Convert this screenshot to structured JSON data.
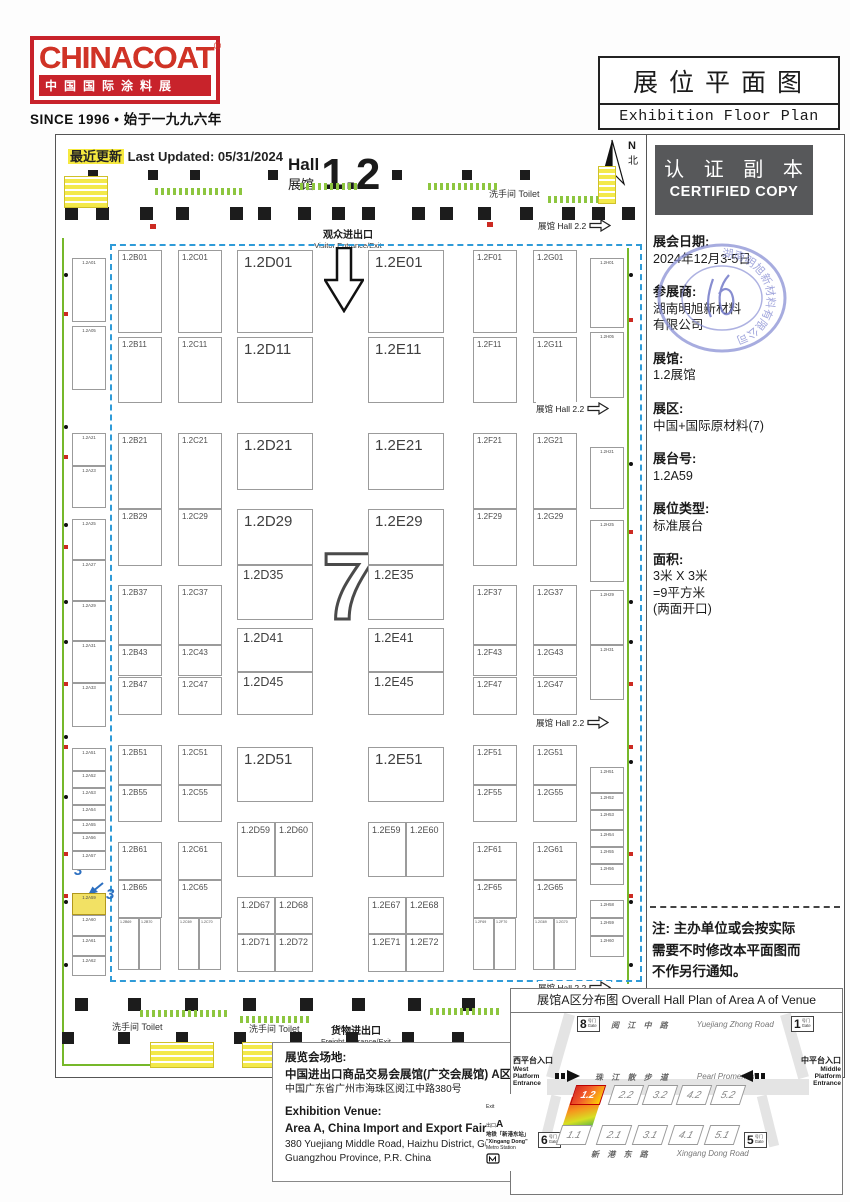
{
  "logo": {
    "brand": "CHINACOAT",
    "reg": "®",
    "subtitle": "中国国际涂料展",
    "since": "SINCE 1996 • 始于一九九六年"
  },
  "title_box": {
    "zh": "展位平面图",
    "en": "Exhibition Floor Plan"
  },
  "certified": {
    "zh": "认 证 副 本",
    "en": "CERTIFIED COPY"
  },
  "sidebar": {
    "stamp_text": "湖南明旭新材料有限公司",
    "details": [
      {
        "label": "展会日期:",
        "lines": [
          "2024年12月3-5日"
        ]
      },
      {
        "label": "参展商:",
        "lines": [
          "湖南明旭新材料",
          "有限公司"
        ]
      },
      {
        "label": "展馆:",
        "lines": [
          "1.2展馆"
        ]
      },
      {
        "label": "展区:",
        "lines": [
          "中国+国际原材料(7)"
        ]
      },
      {
        "label": "展台号:",
        "lines": [
          "1.2A59"
        ]
      },
      {
        "label": "展位类型:",
        "lines": [
          "标准展台"
        ]
      },
      {
        "label": "面积:",
        "lines": [
          "3米 X 3米",
          "=9平方米",
          "(两面开口)"
        ]
      }
    ],
    "note_lines": [
      "注: 主办单位或会按实际",
      "需要不时修改本平面图而",
      "不作另行通知。"
    ]
  },
  "floorplan": {
    "last_updated_zh": "最近更新",
    "last_updated_en": " Last Updated: 05/31/2024",
    "hall_en": "Hall",
    "hall_zh": "展馆",
    "hall_number": "1.2",
    "compass_n": "N",
    "compass_bei": "北",
    "visitor_zh": "观众进出口",
    "visitor_en": "Visitor Entrance/Exit",
    "freight_zh": "货物进出口",
    "freight_en": "Freight Entrance/Exit",
    "toilet_label": "洗手间 Toilet",
    "toilet_markers": [
      {
        "x": 489,
        "y": 187
      },
      {
        "x": 112,
        "y": 1020
      },
      {
        "x": 249,
        "y": 1022
      }
    ],
    "hall22_label": "展馆 Hall 2.2",
    "hall22_markers": [
      {
        "x": 538,
        "y": 219
      },
      {
        "x": 536,
        "y": 402
      },
      {
        "x": 536,
        "y": 716
      },
      {
        "x": 538,
        "y": 981
      }
    ],
    "zone_number": "7",
    "dim_marks": [
      "3",
      "3"
    ],
    "booths": [
      {
        "id": "1.2A01",
        "x": 72,
        "y": 258,
        "w": 34,
        "h": 64,
        "c": "xs"
      },
      {
        "id": "1.2A05",
        "x": 72,
        "y": 326,
        "w": 34,
        "h": 64,
        "c": "xs"
      },
      {
        "id": "1.2A21",
        "x": 72,
        "y": 433,
        "w": 34,
        "h": 33,
        "c": "xs"
      },
      {
        "id": "1.2A23",
        "x": 72,
        "y": 466,
        "w": 34,
        "h": 42,
        "c": "xs"
      },
      {
        "id": "1.2A25",
        "x": 72,
        "y": 519,
        "w": 34,
        "h": 41,
        "c": "xs"
      },
      {
        "id": "1.2A27",
        "x": 72,
        "y": 560,
        "w": 34,
        "h": 41,
        "c": "xs"
      },
      {
        "id": "1.2A29",
        "x": 72,
        "y": 601,
        "w": 34,
        "h": 40,
        "c": "xs"
      },
      {
        "id": "1.2A31",
        "x": 72,
        "y": 641,
        "w": 34,
        "h": 42,
        "c": "xs"
      },
      {
        "id": "1.2A33",
        "x": 72,
        "y": 683,
        "w": 34,
        "h": 44,
        "c": "xs"
      },
      {
        "id": "1.2A51",
        "x": 72,
        "y": 748,
        "w": 34,
        "h": 23,
        "c": "xs"
      },
      {
        "id": "1.2A52",
        "x": 72,
        "y": 771,
        "w": 34,
        "h": 17,
        "c": "xs"
      },
      {
        "id": "1.2A53",
        "x": 72,
        "y": 788,
        "w": 34,
        "h": 17,
        "c": "xs"
      },
      {
        "id": "1.2A54",
        "x": 72,
        "y": 805,
        "w": 34,
        "h": 15,
        "c": "xs"
      },
      {
        "id": "1.2A55",
        "x": 72,
        "y": 820,
        "w": 34,
        "h": 13,
        "c": "xs"
      },
      {
        "id": "1.2A56",
        "x": 72,
        "y": 833,
        "w": 34,
        "h": 18,
        "c": "xs"
      },
      {
        "id": "1.2A57",
        "x": 72,
        "y": 851,
        "w": 34,
        "h": 19,
        "c": "xs"
      },
      {
        "id": "1.2A59",
        "x": 72,
        "y": 893,
        "w": 34,
        "h": 22,
        "c": "xs",
        "hl": true
      },
      {
        "id": "1.2A60",
        "x": 72,
        "y": 915,
        "w": 34,
        "h": 21,
        "c": "xs"
      },
      {
        "id": "1.2A61",
        "x": 72,
        "y": 936,
        "w": 34,
        "h": 20,
        "c": "xs"
      },
      {
        "id": "1.2A62",
        "x": 72,
        "y": 956,
        "w": 34,
        "h": 20,
        "c": "xs"
      },
      {
        "id": "1.2B01",
        "x": 118,
        "y": 250,
        "w": 44,
        "h": 83
      },
      {
        "id": "1.2B11",
        "x": 118,
        "y": 337,
        "w": 44,
        "h": 66
      },
      {
        "id": "1.2B21",
        "x": 118,
        "y": 433,
        "w": 44,
        "h": 76
      },
      {
        "id": "1.2B29",
        "x": 118,
        "y": 509,
        "w": 44,
        "h": 57
      },
      {
        "id": "1.2B37",
        "x": 118,
        "y": 585,
        "w": 44,
        "h": 60
      },
      {
        "id": "1.2B43",
        "x": 118,
        "y": 645,
        "w": 44,
        "h": 31
      },
      {
        "id": "1.2B47",
        "x": 118,
        "y": 677,
        "w": 44,
        "h": 38
      },
      {
        "id": "1.2B51",
        "x": 118,
        "y": 745,
        "w": 44,
        "h": 40
      },
      {
        "id": "1.2B55",
        "x": 118,
        "y": 785,
        "w": 44,
        "h": 37
      },
      {
        "id": "1.2B61",
        "x": 118,
        "y": 842,
        "w": 44,
        "h": 38
      },
      {
        "id": "1.2B65",
        "x": 118,
        "y": 880,
        "w": 44,
        "h": 38
      },
      {
        "id": "1.2B69",
        "x": 118,
        "y": 918,
        "w": 21,
        "h": 52,
        "c": "xxs"
      },
      {
        "id": "1.2B70",
        "x": 139,
        "y": 918,
        "w": 22,
        "h": 52,
        "c": "xxs"
      },
      {
        "id": "1.2C01",
        "x": 178,
        "y": 250,
        "w": 44,
        "h": 83
      },
      {
        "id": "1.2C11",
        "x": 178,
        "y": 337,
        "w": 44,
        "h": 66
      },
      {
        "id": "1.2C21",
        "x": 178,
        "y": 433,
        "w": 44,
        "h": 76
      },
      {
        "id": "1.2C29",
        "x": 178,
        "y": 509,
        "w": 44,
        "h": 57
      },
      {
        "id": "1.2C37",
        "x": 178,
        "y": 585,
        "w": 44,
        "h": 60
      },
      {
        "id": "1.2C43",
        "x": 178,
        "y": 645,
        "w": 44,
        "h": 31
      },
      {
        "id": "1.2C47",
        "x": 178,
        "y": 677,
        "w": 44,
        "h": 38
      },
      {
        "id": "1.2C51",
        "x": 178,
        "y": 745,
        "w": 44,
        "h": 40
      },
      {
        "id": "1.2C55",
        "x": 178,
        "y": 785,
        "w": 44,
        "h": 37
      },
      {
        "id": "1.2C61",
        "x": 178,
        "y": 842,
        "w": 44,
        "h": 38
      },
      {
        "id": "1.2C65",
        "x": 178,
        "y": 880,
        "w": 44,
        "h": 38
      },
      {
        "id": "1.2C69",
        "x": 178,
        "y": 918,
        "w": 21,
        "h": 52,
        "c": "xxs"
      },
      {
        "id": "1.2C70",
        "x": 199,
        "y": 918,
        "w": 22,
        "h": 52,
        "c": "xxs"
      },
      {
        "id": "1.2D01",
        "x": 237,
        "y": 250,
        "w": 76,
        "h": 83,
        "c": "l"
      },
      {
        "id": "1.2D11",
        "x": 237,
        "y": 337,
        "w": 76,
        "h": 66,
        "c": "l"
      },
      {
        "id": "1.2D21",
        "x": 237,
        "y": 433,
        "w": 76,
        "h": 57,
        "c": "l"
      },
      {
        "id": "1.2D29",
        "x": 237,
        "y": 509,
        "w": 76,
        "h": 56,
        "c": "l"
      },
      {
        "id": "1.2D35",
        "x": 237,
        "y": 565,
        "w": 76,
        "h": 55,
        "c": "l2"
      },
      {
        "id": "1.2D41",
        "x": 237,
        "y": 628,
        "w": 76,
        "h": 44,
        "c": "l2"
      },
      {
        "id": "1.2D45",
        "x": 237,
        "y": 672,
        "w": 76,
        "h": 43,
        "c": "l2"
      },
      {
        "id": "1.2D51",
        "x": 237,
        "y": 747,
        "w": 76,
        "h": 55,
        "c": "l"
      },
      {
        "id": "1.2D59",
        "x": 237,
        "y": 822,
        "w": 38,
        "h": 55,
        "c": "m"
      },
      {
        "id": "1.2D60",
        "x": 275,
        "y": 822,
        "w": 38,
        "h": 55,
        "c": "m"
      },
      {
        "id": "1.2D67",
        "x": 237,
        "y": 897,
        "w": 38,
        "h": 37,
        "c": "m"
      },
      {
        "id": "1.2D68",
        "x": 275,
        "y": 897,
        "w": 38,
        "h": 37,
        "c": "m"
      },
      {
        "id": "1.2D71",
        "x": 237,
        "y": 934,
        "w": 38,
        "h": 38,
        "c": "m"
      },
      {
        "id": "1.2D72",
        "x": 275,
        "y": 934,
        "w": 38,
        "h": 38,
        "c": "m"
      },
      {
        "id": "1.2E01",
        "x": 368,
        "y": 250,
        "w": 76,
        "h": 83,
        "c": "l"
      },
      {
        "id": "1.2E11",
        "x": 368,
        "y": 337,
        "w": 76,
        "h": 66,
        "c": "l"
      },
      {
        "id": "1.2E21",
        "x": 368,
        "y": 433,
        "w": 76,
        "h": 57,
        "c": "l"
      },
      {
        "id": "1.2E29",
        "x": 368,
        "y": 509,
        "w": 76,
        "h": 56,
        "c": "l"
      },
      {
        "id": "1.2E35",
        "x": 368,
        "y": 565,
        "w": 76,
        "h": 55,
        "c": "l2"
      },
      {
        "id": "1.2E41",
        "x": 368,
        "y": 628,
        "w": 76,
        "h": 44,
        "c": "l2"
      },
      {
        "id": "1.2E45",
        "x": 368,
        "y": 672,
        "w": 76,
        "h": 43,
        "c": "l2"
      },
      {
        "id": "1.2E51",
        "x": 368,
        "y": 747,
        "w": 76,
        "h": 55,
        "c": "l"
      },
      {
        "id": "1.2E59",
        "x": 368,
        "y": 822,
        "w": 38,
        "h": 55,
        "c": "m"
      },
      {
        "id": "1.2E60",
        "x": 406,
        "y": 822,
        "w": 38,
        "h": 55,
        "c": "m"
      },
      {
        "id": "1.2E67",
        "x": 368,
        "y": 897,
        "w": 38,
        "h": 37,
        "c": "m"
      },
      {
        "id": "1.2E68",
        "x": 406,
        "y": 897,
        "w": 38,
        "h": 37,
        "c": "m"
      },
      {
        "id": "1.2E71",
        "x": 368,
        "y": 934,
        "w": 38,
        "h": 38,
        "c": "m"
      },
      {
        "id": "1.2E72",
        "x": 406,
        "y": 934,
        "w": 38,
        "h": 38,
        "c": "m"
      },
      {
        "id": "1.2F01",
        "x": 473,
        "y": 250,
        "w": 44,
        "h": 83
      },
      {
        "id": "1.2F11",
        "x": 473,
        "y": 337,
        "w": 44,
        "h": 66
      },
      {
        "id": "1.2F21",
        "x": 473,
        "y": 433,
        "w": 44,
        "h": 76
      },
      {
        "id": "1.2F29",
        "x": 473,
        "y": 509,
        "w": 44,
        "h": 57
      },
      {
        "id": "1.2F37",
        "x": 473,
        "y": 585,
        "w": 44,
        "h": 60
      },
      {
        "id": "1.2F43",
        "x": 473,
        "y": 645,
        "w": 44,
        "h": 31
      },
      {
        "id": "1.2F47",
        "x": 473,
        "y": 677,
        "w": 44,
        "h": 38
      },
      {
        "id": "1.2F51",
        "x": 473,
        "y": 745,
        "w": 44,
        "h": 40
      },
      {
        "id": "1.2F55",
        "x": 473,
        "y": 785,
        "w": 44,
        "h": 37
      },
      {
        "id": "1.2F61",
        "x": 473,
        "y": 842,
        "w": 44,
        "h": 38
      },
      {
        "id": "1.2F65",
        "x": 473,
        "y": 880,
        "w": 44,
        "h": 38
      },
      {
        "id": "1.2F69",
        "x": 473,
        "y": 918,
        "w": 21,
        "h": 52,
        "c": "xxs"
      },
      {
        "id": "1.2F70",
        "x": 494,
        "y": 918,
        "w": 22,
        "h": 52,
        "c": "xxs"
      },
      {
        "id": "1.2G01",
        "x": 533,
        "y": 250,
        "w": 44,
        "h": 83
      },
      {
        "id": "1.2G11",
        "x": 533,
        "y": 337,
        "w": 44,
        "h": 66
      },
      {
        "id": "1.2G21",
        "x": 533,
        "y": 433,
        "w": 44,
        "h": 76
      },
      {
        "id": "1.2G29",
        "x": 533,
        "y": 509,
        "w": 44,
        "h": 57
      },
      {
        "id": "1.2G37",
        "x": 533,
        "y": 585,
        "w": 44,
        "h": 60
      },
      {
        "id": "1.2G43",
        "x": 533,
        "y": 645,
        "w": 44,
        "h": 31
      },
      {
        "id": "1.2G47",
        "x": 533,
        "y": 677,
        "w": 44,
        "h": 38
      },
      {
        "id": "1.2G51",
        "x": 533,
        "y": 745,
        "w": 44,
        "h": 40
      },
      {
        "id": "1.2G55",
        "x": 533,
        "y": 785,
        "w": 44,
        "h": 37
      },
      {
        "id": "1.2G61",
        "x": 533,
        "y": 842,
        "w": 44,
        "h": 38
      },
      {
        "id": "1.2G65",
        "x": 533,
        "y": 880,
        "w": 44,
        "h": 38
      },
      {
        "id": "1.2G69",
        "x": 533,
        "y": 918,
        "w": 21,
        "h": 52,
        "c": "xxs"
      },
      {
        "id": "1.2G70",
        "x": 554,
        "y": 918,
        "w": 22,
        "h": 52,
        "c": "xxs"
      },
      {
        "id": "1.2H01",
        "x": 590,
        "y": 258,
        "w": 34,
        "h": 70,
        "c": "xs"
      },
      {
        "id": "1.2H05",
        "x": 590,
        "y": 332,
        "w": 34,
        "h": 66,
        "c": "xs"
      },
      {
        "id": "1.2H21",
        "x": 590,
        "y": 447,
        "w": 34,
        "h": 62,
        "c": "xs"
      },
      {
        "id": "1.2H25",
        "x": 590,
        "y": 520,
        "w": 34,
        "h": 62,
        "c": "xs"
      },
      {
        "id": "1.2H29",
        "x": 590,
        "y": 590,
        "w": 34,
        "h": 55,
        "c": "xs"
      },
      {
        "id": "1.2H31",
        "x": 590,
        "y": 645,
        "w": 34,
        "h": 55,
        "c": "xs"
      },
      {
        "id": "1.2H51",
        "x": 590,
        "y": 767,
        "w": 34,
        "h": 26,
        "c": "xs"
      },
      {
        "id": "1.2H52",
        "x": 590,
        "y": 793,
        "w": 34,
        "h": 17,
        "c": "xs"
      },
      {
        "id": "1.2H53",
        "x": 590,
        "y": 810,
        "w": 34,
        "h": 20,
        "c": "xs"
      },
      {
        "id": "1.2H54",
        "x": 590,
        "y": 830,
        "w": 34,
        "h": 17,
        "c": "xs"
      },
      {
        "id": "1.2H55",
        "x": 590,
        "y": 847,
        "w": 34,
        "h": 17,
        "c": "xs"
      },
      {
        "id": "1.2H56",
        "x": 590,
        "y": 864,
        "w": 34,
        "h": 21,
        "c": "xs"
      },
      {
        "id": "1.2H58",
        "x": 590,
        "y": 900,
        "w": 34,
        "h": 18,
        "c": "xs"
      },
      {
        "id": "1.2H59",
        "x": 590,
        "y": 918,
        "w": 34,
        "h": 18,
        "c": "xs"
      },
      {
        "id": "1.2H60",
        "x": 590,
        "y": 936,
        "w": 34,
        "h": 21,
        "c": "xs"
      }
    ]
  },
  "venue": {
    "lines": [
      {
        "t": "展览会场地:",
        "c": "vb"
      },
      {
        "t": "中国进出口商品交易会展馆(广交会展馆) A区",
        "c": "vb"
      },
      {
        "t": "中国广东省广州市海珠区阅江中路380号",
        "c": "vs"
      },
      {
        "t": "Exhibition Venue:",
        "c": "vb vgap"
      },
      {
        "t": "Area A, China Import and Export Fair Complex",
        "c": "vb"
      },
      {
        "t": "380 Yuejiang Middle Road, Haizhu District, Guangzhou,",
        "c": "vs"
      },
      {
        "t": "Guangzhou Province, P.R. China",
        "c": "vs"
      }
    ]
  },
  "minimap": {
    "title": "展馆A区分布图 Overall Hall Plan of Area A of Venue",
    "gate_suffix": "号门",
    "gate_en": "Gate",
    "gates": [
      {
        "num": "8",
        "x": 66,
        "y": 3
      },
      {
        "num": "1",
        "x": 280,
        "y": 3
      },
      {
        "num": "6",
        "x": 27,
        "y": 119
      },
      {
        "num": "5",
        "x": 233,
        "y": 119
      }
    ],
    "roads": [
      {
        "zh": "阅 江 中 路",
        "en": "Yuejiang Zhong Road",
        "x": 100,
        "y": 7
      },
      {
        "zh": "珠 江 散 步 道",
        "en": "Pearl Promenade",
        "x": 84,
        "y": 59
      },
      {
        "zh": "新 港 东 路",
        "en": "Xingang Dong Road",
        "x": 80,
        "y": 136
      }
    ],
    "west": {
      "zh": "西平台入口",
      "en": [
        "West",
        "Platform",
        "Entrance"
      ]
    },
    "middle": {
      "zh": "中平台入口",
      "en": [
        "Middle",
        "Platform",
        "Entrance"
      ]
    },
    "halls_top": [
      {
        "l": "1.2",
        "x": 62,
        "hl": true
      },
      {
        "l": "2.2",
        "x": 100
      },
      {
        "l": "3.2",
        "x": 134
      },
      {
        "l": "4.2",
        "x": 168
      },
      {
        "l": "5.2",
        "x": 202
      }
    ],
    "halls_bottom": [
      {
        "l": "1.1",
        "x": 48
      },
      {
        "l": "2.1",
        "x": 88
      },
      {
        "l": "3.1",
        "x": 124
      },
      {
        "l": "4.1",
        "x": 160
      },
      {
        "l": "5.1",
        "x": 196
      }
    ],
    "exit": {
      "l1": "Exit",
      "l2": "出口",
      "l3": "A",
      "l4": "地铁「新港东站」",
      "l5": "\"Xingang Dong\"",
      "l6": "Metro Station"
    }
  }
}
